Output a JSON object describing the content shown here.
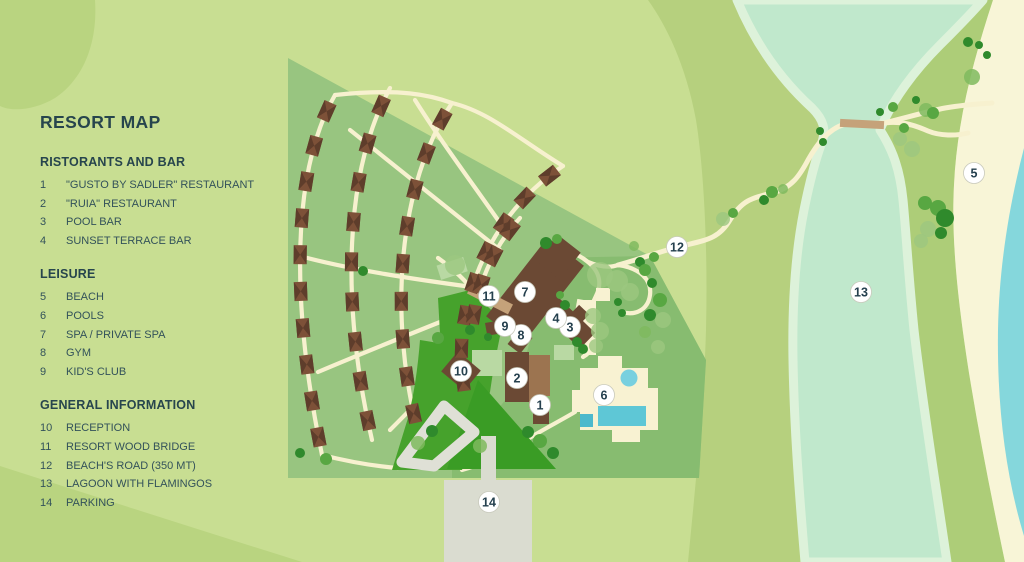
{
  "title": "RESORT MAP",
  "legend": {
    "sections": [
      {
        "heading": "RISTORANTS AND BAR",
        "items": [
          {
            "num": "1",
            "label": "\"GUSTO BY SADLER\" RESTAURANT"
          },
          {
            "num": "2",
            "label": "\"RUIA\" RESTAURANT"
          },
          {
            "num": "3",
            "label": "POOL BAR"
          },
          {
            "num": "4",
            "label": "SUNSET TERRACE BAR"
          }
        ]
      },
      {
        "heading": "LEISURE",
        "items": [
          {
            "num": "5",
            "label": "BEACH"
          },
          {
            "num": "6",
            "label": "POOLS"
          },
          {
            "num": "7",
            "label": "SPA / PRIVATE SPA"
          },
          {
            "num": "8",
            "label": "GYM"
          },
          {
            "num": "9",
            "label": "KID'S CLUB"
          }
        ]
      },
      {
        "heading": "GENERAL INFORMATION",
        "items": [
          {
            "num": "10",
            "label": "RECEPTION"
          },
          {
            "num": "11",
            "label": "RESORT WOOD BRIDGE"
          },
          {
            "num": "12",
            "label": "BEACH'S ROAD (350 MT)"
          },
          {
            "num": "13",
            "label": "LAGOON WITH FLAMINGOS"
          },
          {
            "num": "14",
            "label": "PARKING"
          }
        ]
      }
    ]
  },
  "map": {
    "colors": {
      "background": "#c8de92",
      "swirl": "#b9d480",
      "olive_band": "#b6d07e",
      "lagoon_bank": "#adcd78",
      "beach": "#f8f5d7",
      "sea": "#85d7dc",
      "lagoon": "#c0e8cc",
      "lagoon_edge": "#ddf2da",
      "resort_green": "#98c580",
      "resort_green_east": "#87bc70",
      "lawn_bright": "#46a22c",
      "lawn_dark": "#3a9c25",
      "sage": "#b9d9a3",
      "path_cream": "#f7f1cf",
      "driveway_gray": "#dfe0d6",
      "parking_gray": "#dadcd0",
      "building_dark_brown": "#6b4934",
      "building_light_brown": "#9c7450",
      "villa_roof": "#7d5138",
      "villa_roof_dark": "#5e3d2b",
      "wood_bridge_tan": "#c5a27a",
      "pool_blue": "#5ec7d6",
      "pool_blue_dark": "#4db9cc",
      "pool_blue_light": "#78d0df",
      "tree_dark": "#2f8a2c",
      "tree_mid": "#58a742",
      "tree_light": "#7fba5e",
      "tree_pale": "#9cc77f",
      "marker_text": "#25404e"
    },
    "markers": [
      {
        "n": "1",
        "x": 540,
        "y": 405
      },
      {
        "n": "2",
        "x": 517,
        "y": 378
      },
      {
        "n": "3",
        "x": 570,
        "y": 327
      },
      {
        "n": "4",
        "x": 556,
        "y": 318
      },
      {
        "n": "5",
        "x": 974,
        "y": 173
      },
      {
        "n": "6",
        "x": 604,
        "y": 395
      },
      {
        "n": "7",
        "x": 525,
        "y": 292
      },
      {
        "n": "8",
        "x": 521,
        "y": 335
      },
      {
        "n": "9",
        "x": 505,
        "y": 326
      },
      {
        "n": "10",
        "x": 461,
        "y": 371
      },
      {
        "n": "11",
        "x": 489,
        "y": 296
      },
      {
        "n": "12",
        "x": 677,
        "y": 247
      },
      {
        "n": "13",
        "x": 861,
        "y": 292
      },
      {
        "n": "14",
        "x": 489,
        "y": 502
      }
    ],
    "villa_rows": [
      {
        "d": "M335,95 C292,170 290,300 322,455",
        "n": 10
      },
      {
        "d": "M390,88 C345,170 340,300 372,440",
        "n": 9
      },
      {
        "d": "M452,103 C398,185 388,315 418,432",
        "n": 9
      },
      {
        "d": "M563,166 C474,225 450,330 466,398",
        "n": 8
      },
      {
        "d": "M520,218 C492,248 476,288 472,330",
        "n": 4
      }
    ],
    "cross_paths": [
      "M335,95 C400,88 430,95 452,103 C490,112 520,140 563,166",
      "M472,287 C420,280 350,270 296,255",
      "M470,310 C420,330 370,350 318,372",
      "M480,330 C450,370 420,400 390,430",
      "M500,250 C450,210 400,170 350,130",
      "M505,230 C470,180 440,140 415,100",
      "M322,455 C350,462 372,466 398,468"
    ],
    "service_paths": [
      "M438,258 C452,268 462,277 470,287",
      "M510,312 C516,316 522,320 528,324",
      "M545,254 C562,248 576,252 588,262 C600,272 602,284 596,296 C590,308 588,318 592,330 C596,342 592,352 583,357",
      "M588,262 C600,267 610,268 618,265",
      "M618,265 C640,268 652,280 650,295 C648,310 635,316 622,312",
      "M575,412 C558,422 542,430 528,439 C514,447 502,453 490,459",
      "M490,459 C480,464 470,468 462,470"
    ],
    "beach_road": [
      "M618,265 C640,259 652,254 678,247 C705,240 718,240 730,220 C742,200 752,198 772,193 C792,188 800,175 808,160 C816,146 828,128 846,124 L884,123 C900,121 912,124 928,131 C940,136 956,136 968,133",
      "M884,123 C905,118 925,112 945,108 C962,105 976,104 992,103"
    ],
    "trees": [
      [
        546,
        243,
        6,
        "d"
      ],
      [
        557,
        239,
        5,
        "m"
      ],
      [
        600,
        275,
        13,
        "p"
      ],
      [
        617,
        281,
        11,
        "p"
      ],
      [
        630,
        292,
        9,
        "p"
      ],
      [
        640,
        262,
        5,
        "d"
      ],
      [
        654,
        257,
        5,
        "m"
      ],
      [
        618,
        302,
        4,
        "d"
      ],
      [
        622,
        313,
        4,
        "d"
      ],
      [
        593,
        316,
        8,
        "p"
      ],
      [
        600,
        331,
        9,
        "p"
      ],
      [
        596,
        346,
        7,
        "p"
      ],
      [
        577,
        342,
        5,
        "d"
      ],
      [
        583,
        349,
        5,
        "d"
      ],
      [
        565,
        305,
        5,
        "d"
      ],
      [
        560,
        295,
        4,
        "m"
      ],
      [
        660,
        300,
        7,
        "m"
      ],
      [
        650,
        315,
        6,
        "d"
      ],
      [
        663,
        320,
        8,
        "p"
      ],
      [
        645,
        332,
        6,
        "l"
      ],
      [
        658,
        347,
        7,
        "p"
      ],
      [
        723,
        219,
        7,
        "p"
      ],
      [
        733,
        213,
        5,
        "m"
      ],
      [
        764,
        200,
        5,
        "d"
      ],
      [
        772,
        192,
        6,
        "m"
      ],
      [
        783,
        189,
        5,
        "l"
      ],
      [
        820,
        131,
        4,
        "d"
      ],
      [
        823,
        142,
        4,
        "d"
      ],
      [
        900,
        139,
        7,
        "p"
      ],
      [
        912,
        149,
        8,
        "p"
      ],
      [
        904,
        128,
        5,
        "m"
      ],
      [
        880,
        112,
        4,
        "d"
      ],
      [
        893,
        107,
        5,
        "m"
      ],
      [
        925,
        203,
        7,
        "m"
      ],
      [
        938,
        208,
        8,
        "m"
      ],
      [
        945,
        218,
        9,
        "d"
      ],
      [
        928,
        229,
        8,
        "p"
      ],
      [
        941,
        233,
        6,
        "d"
      ],
      [
        921,
        241,
        7,
        "p"
      ],
      [
        968,
        42,
        5,
        "d"
      ],
      [
        979,
        45,
        4,
        "d"
      ],
      [
        987,
        55,
        4,
        "d"
      ],
      [
        972,
        77,
        8,
        "l"
      ],
      [
        916,
        100,
        4,
        "d"
      ],
      [
        926,
        110,
        7,
        "l"
      ],
      [
        933,
        113,
        6,
        "m"
      ],
      [
        438,
        338,
        6,
        "m"
      ],
      [
        300,
        453,
        5,
        "d"
      ],
      [
        326,
        459,
        6,
        "m"
      ],
      [
        363,
        271,
        5,
        "d"
      ],
      [
        455,
        265,
        10,
        "p"
      ],
      [
        470,
        330,
        5,
        "d"
      ],
      [
        488,
        337,
        4,
        "d"
      ],
      [
        418,
        443,
        7,
        "l"
      ],
      [
        432,
        431,
        6,
        "d"
      ],
      [
        528,
        432,
        6,
        "d"
      ],
      [
        540,
        441,
        7,
        "m"
      ],
      [
        553,
        453,
        6,
        "d"
      ],
      [
        480,
        446,
        7,
        "l"
      ],
      [
        645,
        270,
        6,
        "m"
      ],
      [
        652,
        283,
        5,
        "d"
      ],
      [
        634,
        246,
        5,
        "l"
      ]
    ]
  }
}
